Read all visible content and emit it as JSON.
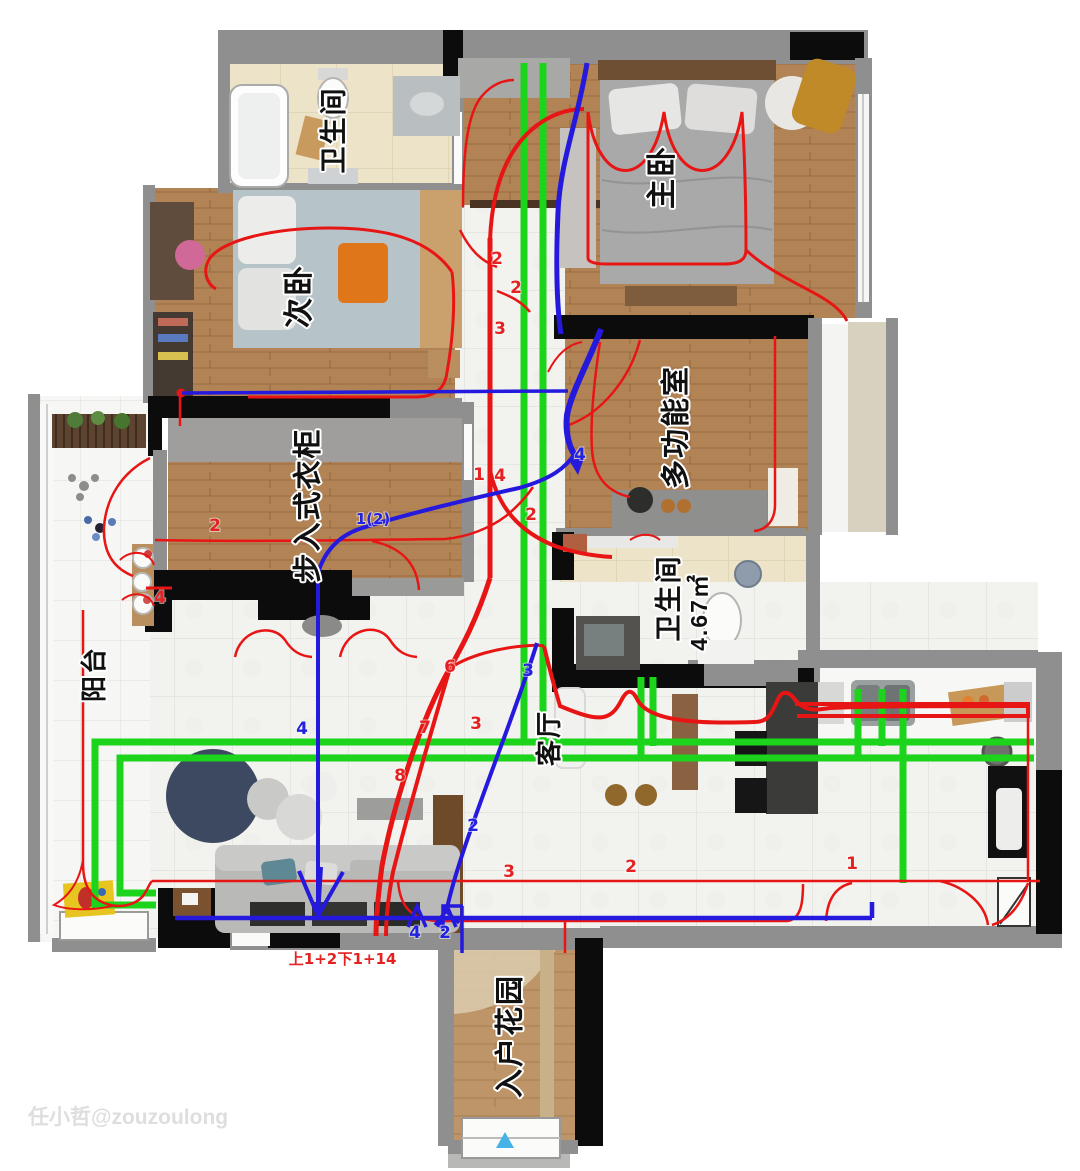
{
  "watermark": {
    "text": "任小哲@zouzoulong",
    "color": "#d9d9d9"
  },
  "colors": {
    "red_circuit": "#e81515",
    "green_circuit": "#1bd41b",
    "blue_circuit": "#2419dc",
    "label_fill": "#101010",
    "label_stroke": "#ffffff",
    "annotation_red": "#e42222",
    "annotation_blue": "#2222e0",
    "entry_arrow": "#45b2e8"
  },
  "rooms": [
    {
      "id": "bathroom-top",
      "label": "卫生间",
      "cx": 336,
      "cy": 130,
      "size": 27
    },
    {
      "id": "secondary-bedroom",
      "label": "次卧",
      "cx": 301,
      "cy": 296,
      "size": 30
    },
    {
      "id": "master-bedroom",
      "label": "主卧",
      "cx": 664,
      "cy": 177,
      "size": 30
    },
    {
      "id": "multi-function",
      "label": "多功能室",
      "cx": 678,
      "cy": 427,
      "size": 29
    },
    {
      "id": "walk-in-closet",
      "label": "步入式衣柜",
      "cx": 310,
      "cy": 505,
      "size": 29
    },
    {
      "id": "bathroom-main",
      "label": "卫生间",
      "cx": 671,
      "cy": 598,
      "size": 27
    },
    {
      "id": "bathroom-main-area",
      "label": "4.67㎡",
      "cx": 701,
      "cy": 612,
      "size": 23
    },
    {
      "id": "balcony",
      "label": "阳台",
      "cx": 96,
      "cy": 674,
      "size": 26
    },
    {
      "id": "living-room",
      "label": "客厅",
      "cx": 551,
      "cy": 738,
      "size": 26
    },
    {
      "id": "entry-garden",
      "label": "入户花园",
      "cx": 512,
      "cy": 1036,
      "size": 29
    }
  ],
  "annotations": [
    {
      "text": "2",
      "x": 497,
      "y": 264,
      "color": "red"
    },
    {
      "text": "2",
      "x": 516,
      "y": 293,
      "color": "red"
    },
    {
      "text": "3",
      "x": 500,
      "y": 334,
      "color": "red"
    },
    {
      "text": "1",
      "x": 479,
      "y": 480,
      "color": "red"
    },
    {
      "text": "4",
      "x": 500,
      "y": 481,
      "color": "red"
    },
    {
      "text": "2",
      "x": 531,
      "y": 520,
      "color": "red"
    },
    {
      "text": "2",
      "x": 215,
      "y": 531,
      "color": "red"
    },
    {
      "text": "4",
      "x": 160,
      "y": 603,
      "color": "red"
    },
    {
      "text": "6",
      "x": 450,
      "y": 672,
      "color": "red"
    },
    {
      "text": "3",
      "x": 476,
      "y": 729,
      "color": "red"
    },
    {
      "text": "7",
      "x": 425,
      "y": 733,
      "color": "red"
    },
    {
      "text": "8",
      "x": 400,
      "y": 781,
      "color": "red"
    },
    {
      "text": "3",
      "x": 509,
      "y": 877,
      "color": "red"
    },
    {
      "text": "2",
      "x": 631,
      "y": 872,
      "color": "red"
    },
    {
      "text": "1",
      "x": 852,
      "y": 869,
      "color": "red"
    },
    {
      "text": "上1+2",
      "x": 313,
      "y": 964,
      "color": "red",
      "size": 15
    },
    {
      "text": "下1+14",
      "x": 367,
      "y": 964,
      "color": "red",
      "size": 15
    },
    {
      "text": "1(2)",
      "x": 373,
      "y": 524,
      "color": "blue",
      "size": 15
    },
    {
      "text": "4",
      "x": 580,
      "y": 460,
      "color": "blue"
    },
    {
      "text": "3",
      "x": 528,
      "y": 676,
      "color": "blue"
    },
    {
      "text": "4",
      "x": 302,
      "y": 734,
      "color": "blue"
    },
    {
      "text": "2",
      "x": 473,
      "y": 831,
      "color": "blue"
    },
    {
      "text": "4",
      "x": 415,
      "y": 938,
      "color": "blue"
    },
    {
      "text": "2",
      "x": 445,
      "y": 938,
      "color": "blue"
    }
  ]
}
